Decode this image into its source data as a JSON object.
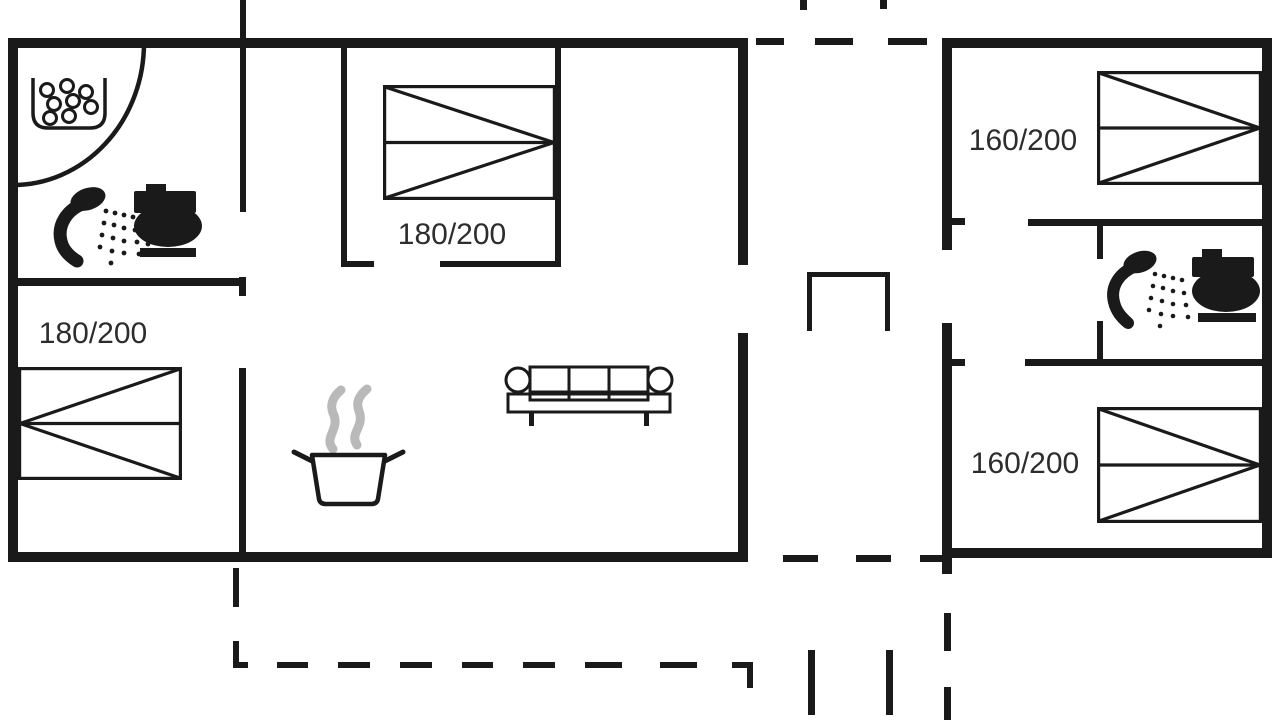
{
  "floorplan": {
    "main_house": {
      "bedroom_top": {
        "bed_size_label": "180/200"
      },
      "bedroom_left": {
        "bed_size_label": "180/200"
      },
      "bathroom": {
        "fixtures": [
          "whirlpool-tub",
          "shower",
          "toilet"
        ]
      },
      "living_area": {
        "furniture": [
          "sofa",
          "cooking-pot"
        ]
      }
    },
    "annex": {
      "bedroom_top": {
        "bed_size_label": "160/200"
      },
      "bedroom_bottom": {
        "bed_size_label": "160/200"
      },
      "bathroom": {
        "fixtures": [
          "shower",
          "toilet"
        ]
      }
    }
  },
  "icons": {
    "whirlpool-tub-icon": "open-top tub outline with bubble circles",
    "shower-icon": "handheld shower head with spray dots",
    "toilet-icon": "side-view toilet silhouette",
    "double-bed-icon": "rectangle with two triangles and center line",
    "sofa-icon": "three-seat sofa top view",
    "cooking-pot-icon": "pot with handles and rising steam",
    "door-arc": "quarter-circle swing line",
    "dashed-line": "terrace / passage boundary"
  },
  "colors": {
    "line": "#1a1a1a",
    "steam": "#b9b9b9",
    "text": "#2d2d2d",
    "background": "#ffffff"
  }
}
